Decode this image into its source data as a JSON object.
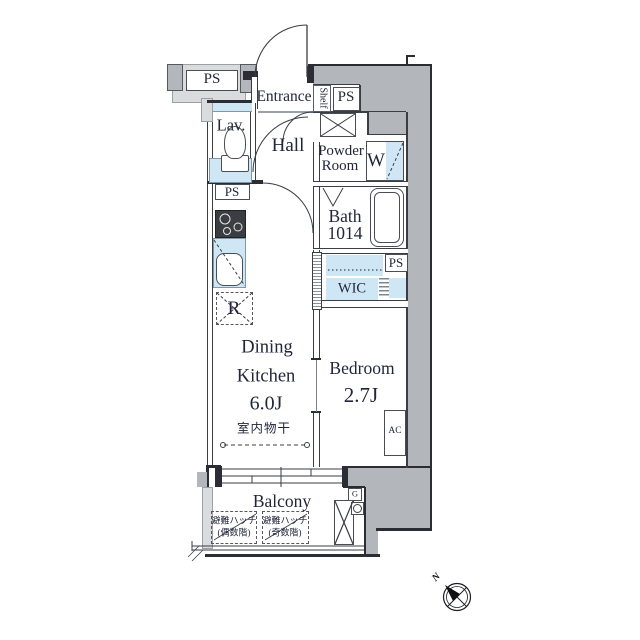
{
  "colors": {
    "wall_dark": "#b3b7bc",
    "wall_light": "#dadbdc",
    "fixture_blue": "#cfe7f5",
    "line": "#3a3d44",
    "text": "#23263a"
  },
  "plan": {
    "pipe_spaces": {
      "top_left": "PS",
      "top_right": "PS",
      "lavatory": "PS",
      "closet": "PS"
    },
    "rooms": {
      "entrance": "Entrance",
      "shelf": "Shelf",
      "lavatory": "Lav.",
      "hall": "Hall",
      "powder_line1": "Powder",
      "powder_line2": "Room",
      "washer": "W",
      "bath_line1": "Bath",
      "bath_line2": "1014",
      "wic": "WIC",
      "refrigerator": "R",
      "dining_line1": "Dining",
      "dining_line2": "Kitchen",
      "dining_size": "6.0J",
      "bedroom": "Bedroom",
      "bedroom_size": "2.7J",
      "ac": "AC",
      "indoor_drying": "室内物干",
      "balcony": "Balcony",
      "gas_meter": "G"
    },
    "balcony_hatches": [
      {
        "line1": "避難ハッチ",
        "line2": "(偶数階)"
      },
      {
        "line1": "避難ハッチ",
        "line2": "(奇数階)"
      }
    ],
    "compass": {
      "north_label": "N"
    }
  }
}
